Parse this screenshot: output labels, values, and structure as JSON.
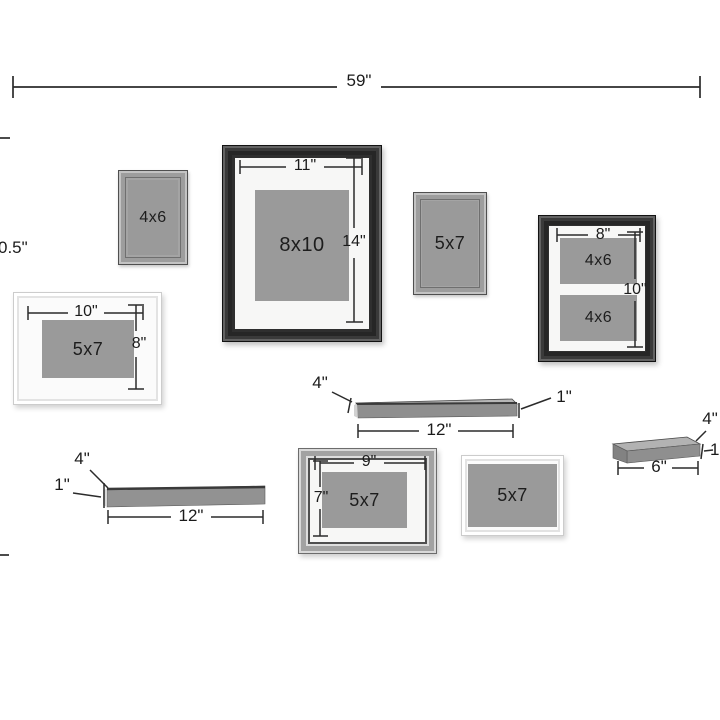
{
  "diagram": {
    "overall_width_label": "59\"",
    "left_height_label": "0.5\"",
    "line_color": "#2b2b2b",
    "photo_color": "#9a9a9a",
    "mat_color": "#f7f7f6",
    "shelf_color": "#8f8f8f"
  },
  "frames": [
    {
      "name": "small-gray-portrait-frame",
      "photo_label": "4x6"
    },
    {
      "name": "large-black-portrait-frame",
      "photo_label": "8x10",
      "width_label": "11\"",
      "height_label": "14\""
    },
    {
      "name": "gray-portrait-frame",
      "photo_label": "5x7"
    },
    {
      "name": "black-double-opening-frame",
      "width_label": "8\"",
      "height_label": "10\"",
      "openings": [
        "4x6",
        "4x6"
      ]
    },
    {
      "name": "white-landscape-frame-left",
      "photo_label": "5x7",
      "width_label": "10\"",
      "height_label": "8\""
    },
    {
      "name": "silver-landscape-frame",
      "photo_label": "5x7",
      "width_label": "9\"",
      "height_label": "7\""
    },
    {
      "name": "white-landscape-frame-right",
      "photo_label": "5x7"
    }
  ],
  "shelves": [
    {
      "name": "center-shelf",
      "depth_label": "4\"",
      "thickness_label": "1\"",
      "length_label": "12\""
    },
    {
      "name": "left-shelf",
      "depth_label": "4\"",
      "thickness_label": "1\"",
      "length_label": "12\""
    },
    {
      "name": "right-shelf",
      "depth_label": "4\"",
      "thickness_label": "1\"",
      "length_label": "6\""
    }
  ]
}
